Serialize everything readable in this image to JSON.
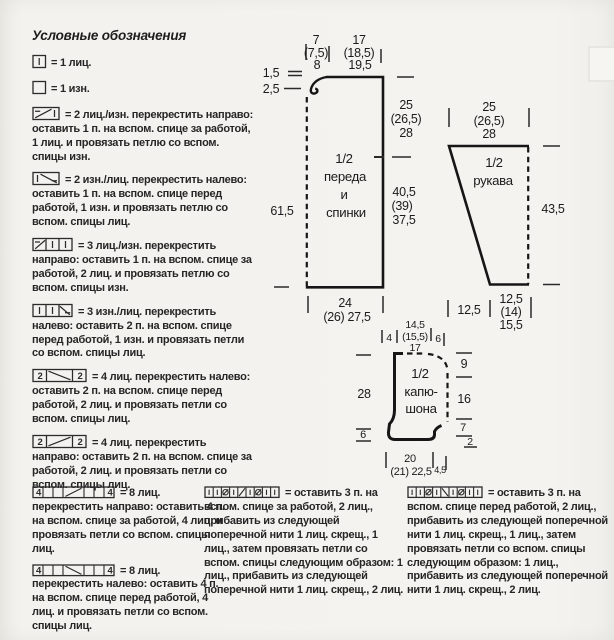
{
  "page": {
    "paper": "#f3f2ee",
    "ink": "#1f1f1f"
  },
  "title": "Условные обозначения",
  "legend": [
    {
      "icon": "knit-stitch-cell-icon",
      "text": "= 1 лиц."
    },
    {
      "icon": "purl-stitch-cell-icon",
      "text": "= 1 изн."
    },
    {
      "icon": "cross-2-right-icon",
      "text": "= 2 лиц./изн. перекрестить направо: оставить 1 п. на вспом. спице за работой, 1 лиц. и провязать петлю со вспом. спицы изн."
    },
    {
      "icon": "cross-2-left-icon",
      "text": "= 2 изн./лиц. перекрестить налево: оставить 1 п. на вспом. спице перед работой, 1 изн. и провязать петлю со вспом. спицы лиц."
    },
    {
      "icon": "cross-3-right-icon",
      "text": "= 3 лиц./изн. перекрестить направо: оставить 1 п. на вспом. спице за работой, 2 лиц. и провязать петлю со вспом. спицы изн."
    },
    {
      "icon": "cross-3-left-icon",
      "text": "= 3 изн./лиц. перекрестить налево: оставить 2 п. на вспом. спице перед работой, 1 изн. и провязать петли со вспом. спицы лиц."
    },
    {
      "icon": "cable-4-left-icon",
      "cells": [
        "2",
        "2"
      ],
      "text": "= 4 лиц. перекрестить налево: оставить 2 п. на вспом. спице перед работой, 2 лиц. и провязать петли со вспом. спицы лиц."
    },
    {
      "icon": "cable-4-right-icon",
      "cells": [
        "2",
        "2"
      ],
      "text": "= 4 лиц. перекрестить направо: оставить 2 п. на вспом. спице за работой, 2 лиц. и провязать петли со вспом. спицы лиц."
    }
  ],
  "legend_bottom": {
    "col1": [
      {
        "icon": "cable-8-right-icon",
        "cells": [
          "4",
          "4"
        ],
        "text": "= 8 лиц. перекрестить направо: оставить 4 п. на вспом. спице за работой, 4 лиц. и провязать петли со вспом. спицы лиц."
      },
      {
        "icon": "cable-8-left-icon",
        "cells": [
          "4",
          "4"
        ],
        "text": "= 8 лиц. перекрестить налево: оставить 4 п. на вспом. спице перед работой, 4 лиц. и провязать петли со вспом. спицы лиц."
      }
    ],
    "col2": {
      "icon": "cross-increase-right-icon",
      "text": "= оставить 3 п. на вспом. спице за работой, 2 лиц., прибавить из следующей поперечной нити 1 лиц. скрещ., 1 лиц., затем провязать петли со вспом. спицы следующим образом: 1 лиц., прибавить из следующей поперечной нити 1 лиц. скрещ., 2 лиц."
    },
    "col3": {
      "icon": "cross-increase-left-icon",
      "text": "= оставить 3 п. на вспом. спице перед работой, 2 лиц., прибавить из следующей поперечной нити 1 лиц. скрещ., 1 лиц., затем провязать петли со вспом. спицы следующим образом: 1 лиц., прибавить из следующей поперечной нити 1 лиц. скрещ., 2 лиц."
    },
    "footer": {
      "prefix": "A",
      "text": "= узор \"шиповник\""
    }
  },
  "schematic": {
    "front_back": {
      "label_lines": [
        "1/2",
        "переда",
        "и",
        "спинки"
      ],
      "shoulder": [
        "7",
        "(7,5)",
        "8"
      ],
      "neck": [
        "17",
        "(18,5)",
        "19,5"
      ],
      "neck_depth_small": "1,5",
      "neck_depth_large": "2,5",
      "height": "61,5",
      "side_upper": [
        "25",
        "(26,5)",
        "28"
      ],
      "side_lower": [
        "40,5",
        "(39)",
        "37,5"
      ],
      "bottom_width": [
        "24",
        "(26) 27,5"
      ]
    },
    "sleeve": {
      "label_lines": [
        "1/2",
        "рукава"
      ],
      "top_width": [
        "25",
        "(26,5)",
        "28"
      ],
      "side_height": "43,5",
      "bottom_slant": "12,5",
      "bottom_width": [
        "12,5",
        "(14)",
        "15,5"
      ]
    },
    "hood": {
      "label_lines": [
        "1/2",
        "капю-",
        "шона"
      ],
      "top_left_seg": "4",
      "top_mid": [
        "14,5",
        "(15,5)",
        "17"
      ],
      "top_right_seg": "6",
      "back_height": "28",
      "front_lower_seg": "6",
      "right_seg_top": "9",
      "right_seg_mid": "16",
      "right_seg_low": "7",
      "right_seg_corner": "2",
      "bottom_width": [
        "20",
        "(21) 22,5"
      ],
      "bottom_right_seg": "4,5"
    }
  }
}
